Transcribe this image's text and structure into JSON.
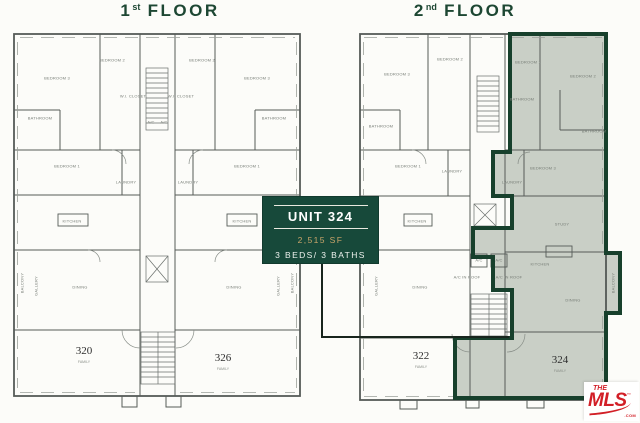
{
  "floor_titles": {
    "first": {
      "number": "1",
      "ordinal": "st",
      "word": "FLOOR"
    },
    "second": {
      "number": "2",
      "ordinal": "nd",
      "word": "FLOOR"
    }
  },
  "unit_card": {
    "title": "UNIT 324",
    "area": "2,515 SF",
    "beds_baths": "3 BEDS/ 3 BATHS"
  },
  "plans": {
    "first": {
      "units": [
        {
          "number": "320",
          "caption": "FAMILY"
        },
        {
          "number": "326",
          "caption": "FAMILY"
        }
      ],
      "rooms": [
        "BEDROOM 3",
        "BEDROOM 2",
        "BATHROOM",
        "BEDROOM 1",
        "W.I. CLOSET",
        "LAUNDRY",
        "KITCHEN",
        "DINING",
        "GALLERY",
        "BEDROOM 2",
        "BEDROOM 3",
        "BATHROOM",
        "BEDROOM 1",
        "W.I. CLOSET",
        "LAUNDRY",
        "KITCHEN",
        "DINING",
        "GALLERY",
        "A/C",
        "A/C",
        "BALCONY",
        "BALCONY"
      ]
    },
    "second": {
      "units": [
        {
          "number": "322",
          "caption": "FAMILY"
        },
        {
          "number": "324",
          "caption": "FAMILY"
        }
      ],
      "rooms": [
        "BEDROOM 3",
        "BEDROOM 2",
        "BATHROOM",
        "BEDROOM 1",
        "LAUNDRY",
        "KITCHEN",
        "DINING",
        "GALLERY",
        "BEDROOM 1",
        "BEDROOM 2",
        "BATHROOM",
        "BATHROOM",
        "BEDROOM 3",
        "LAUNDRY",
        "STUDY",
        "KITCHEN",
        "DINING",
        "BALCONY",
        "A/C",
        "A/C",
        "A/C IN ROOF",
        "A/C IN ROOF"
      ]
    }
  },
  "colors": {
    "title_green": "#1d4733",
    "card_green": "#17493a",
    "card_gold": "#c9a56a",
    "highlight_fill": "#c9cfc6",
    "highlight_border": "#17402c",
    "mls_red": "#d21f27"
  },
  "logo": {
    "the": "THE",
    "mls": "MLS",
    "tm": "™",
    "com": ".COM"
  }
}
